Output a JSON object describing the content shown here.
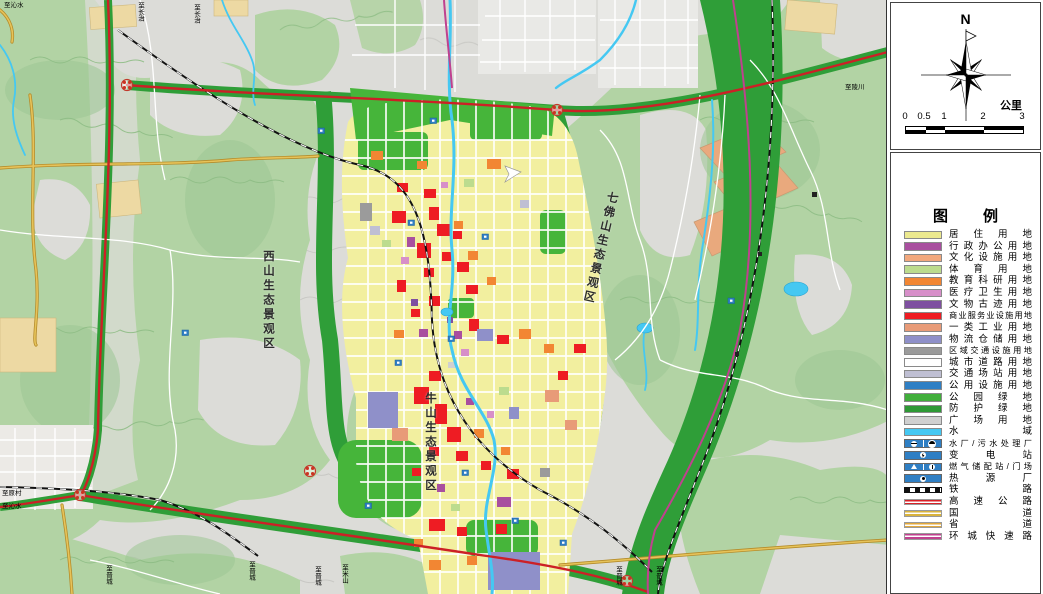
{
  "panel": {
    "north_label": "N",
    "scale_unit": "公里",
    "scale_ticks": [
      "0",
      "0.5",
      "1",
      "2",
      "3"
    ],
    "legend_title": "图　例",
    "legend": {
      "items": [
        {
          "label": "居住用地",
          "type": "swatch",
          "color": "#ece98f"
        },
        {
          "label": "行政办公用地",
          "type": "swatch",
          "color": "#a94f9f"
        },
        {
          "label": "文化设施用地",
          "type": "swatch",
          "color": "#f2a87d"
        },
        {
          "label": "体育用地",
          "type": "swatch",
          "color": "#bcdc8e"
        },
        {
          "label": "教育科研用地",
          "type": "swatch",
          "color": "#f28633"
        },
        {
          "label": "医疗卫生用地",
          "type": "swatch",
          "color": "#d78fc9"
        },
        {
          "label": "文物古迹用地",
          "type": "swatch",
          "color": "#7e4fa0"
        },
        {
          "label": "商业服务业设施用地",
          "type": "swatch",
          "color": "#ee1c23"
        },
        {
          "label": "一类工业用地",
          "type": "swatch",
          "color": "#e89b78"
        },
        {
          "label": "物流仓储用地",
          "type": "swatch",
          "color": "#8f90c9"
        },
        {
          "label": "区域交通设施用地",
          "type": "swatch",
          "color": "#9b9b9b"
        },
        {
          "label": "城市道路用地",
          "type": "swatch",
          "color": "#ffffff"
        },
        {
          "label": "交通场站用地",
          "type": "swatch",
          "color": "#bfbfd3"
        },
        {
          "label": "公用设施用地",
          "type": "swatch",
          "color": "#2f7fc4"
        },
        {
          "label": "公园绿地",
          "type": "swatch",
          "color": "#41ae3b"
        },
        {
          "label": "防护绿地",
          "type": "swatch",
          "color": "#2e9935"
        },
        {
          "label": "广场用地",
          "type": "swatch",
          "color": "#d0d0d0"
        },
        {
          "label": "水域",
          "type": "swatch",
          "color": "#45c8f2"
        },
        {
          "label": "水厂/污水处理厂",
          "type": "icon-water-plant"
        },
        {
          "label": "变电站",
          "type": "icon-substation"
        },
        {
          "label": "燃气储配站/门场",
          "type": "icon-gas-station"
        },
        {
          "label": "热源厂",
          "type": "icon-heat-plant"
        },
        {
          "label": "铁路",
          "type": "line-railway"
        },
        {
          "label": "高速公路",
          "type": "line-expressway",
          "color": "#d92027"
        },
        {
          "label": "国道",
          "type": "line-national-road",
          "color": "#d9b33c"
        },
        {
          "label": "省道",
          "type": "line-provincial-road",
          "color": "#e3a93c"
        },
        {
          "label": "环城快速路",
          "type": "line-ring-expressway",
          "color": "#c0418f"
        }
      ]
    }
  },
  "map": {
    "region_labels": [
      {
        "text": "西山生态景观区"
      },
      {
        "text": "七佛山生态景观区"
      },
      {
        "text": "牛山生态景观区"
      }
    ],
    "edge_labels": [
      {
        "text": "至沁水"
      },
      {
        "text": "至长治"
      },
      {
        "text": "至长治"
      },
      {
        "text": "至陵川"
      },
      {
        "text": "至原村"
      },
      {
        "text": "至沁水"
      },
      {
        "text": "至晋城"
      },
      {
        "text": "至晋城"
      },
      {
        "text": "至晋城"
      },
      {
        "text": "至米山"
      },
      {
        "text": "至晋城"
      },
      {
        "text": "至晋城"
      }
    ],
    "colors": {
      "terrain": "#dcdcd8",
      "hills": "#b2d3a4",
      "protective_green": "#2f9e38",
      "park_green": "#46b53a",
      "residential": "#f2ef9f",
      "water": "#45c8f2",
      "expressway": "#cc2026",
      "national_road": "#e0b24a",
      "ring_road": "#c0418f"
    }
  }
}
